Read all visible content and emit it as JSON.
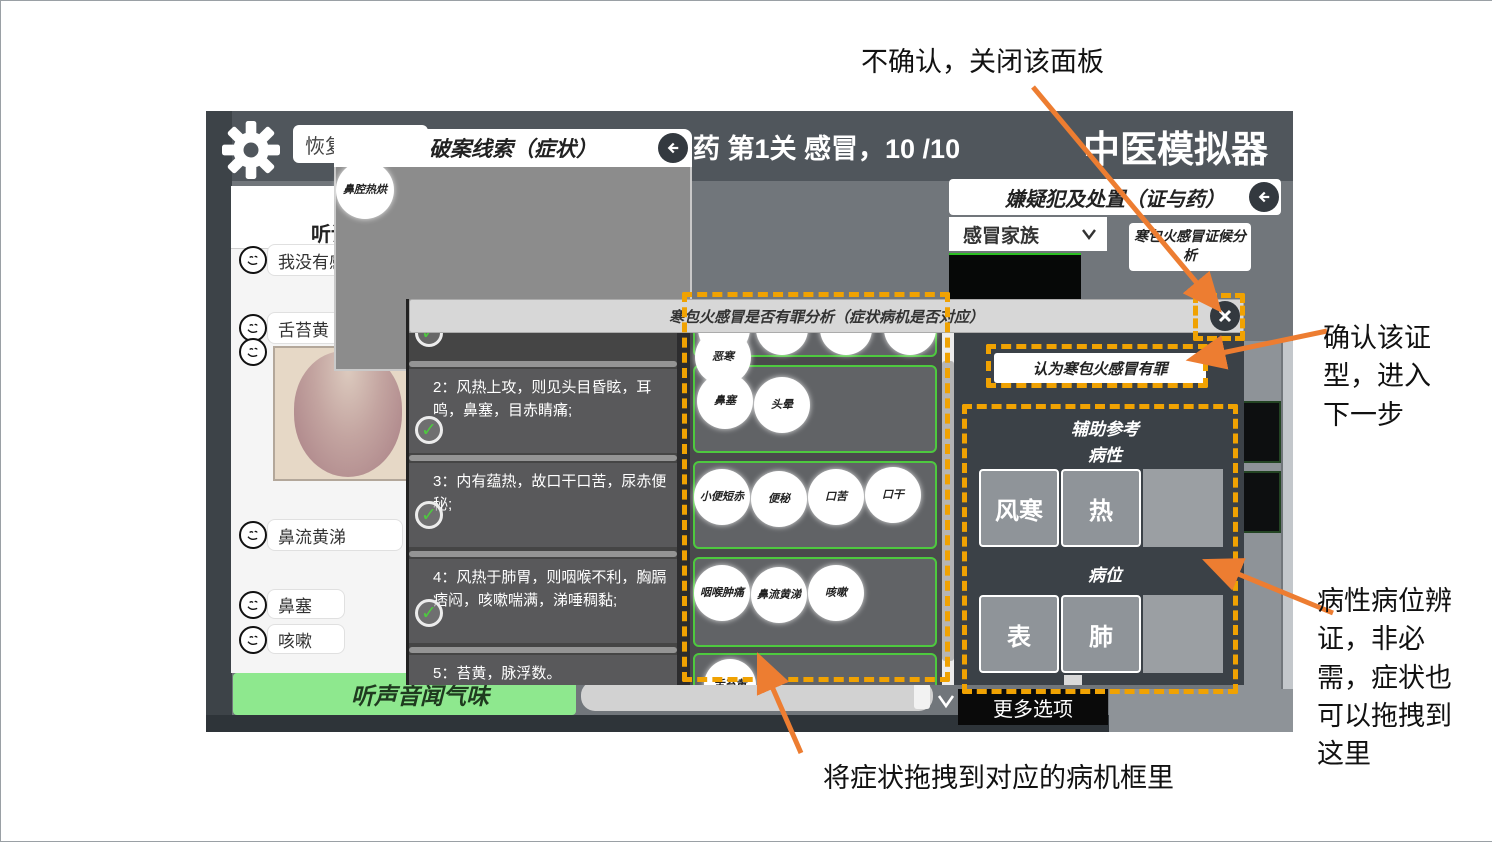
{
  "annotations": {
    "close_note": "不确认，关闭该面板",
    "confirm_note": "确认该证型，进入下一步",
    "aux_note": "病性病位辨证，非必需，症状也可以拖拽到这里",
    "drag_note": "将症状拖拽到对应的病机框里"
  },
  "header": {
    "restore": "恢复",
    "level": "药 第1关 感冒，10 /10",
    "app_title": "中医模拟器"
  },
  "clue_panel": {
    "title": "破案线索（症状）",
    "clue": "鼻腔热烘"
  },
  "chat": {
    "tab": "听诊",
    "messages": [
      "我没有感",
      "舌苔黄",
      "鼻流黄涕",
      "鼻塞",
      "咳嗽"
    ],
    "listen_button": "听声音闻气味"
  },
  "suspects": {
    "title": "嫌疑犯及处置（证与药）",
    "family": "感冒家族",
    "current": "风寒感冒",
    "analysis": "寒包火感冒证候分析",
    "more": "更多选项"
  },
  "dialog": {
    "title": "寒包火感冒是否有罪分析（症状病机是否对应）",
    "items": [
      "2：风热上攻，则见头目昏眩，耳鸣，鼻塞，目赤睛痛;",
      "3：内有蕴热，故口干口苦，尿赤便秘;",
      "4：风热于肺胃，则咽喉不利，胸膈痞闷，咳嗽喘满，涕唾稠黏;",
      "5：苔黄，脉浮数。"
    ],
    "symptoms": {
      "dragging": "恶寒",
      "zone2": [
        "鼻塞",
        "头晕"
      ],
      "zone3": [
        "小便短赤",
        "便秘",
        "口苦",
        "口干"
      ],
      "zone4": [
        "咽喉肿痛",
        "鼻流黄涕",
        "咳嗽"
      ],
      "zone5": [
        "舌苔黄"
      ]
    },
    "verdict_button": "认为寒包火感冒有罪",
    "aux": {
      "title": "辅助参考",
      "nature_label": "病性",
      "nature": [
        "风寒",
        "热"
      ],
      "location_label": "病位",
      "location": [
        "表",
        "肺"
      ]
    }
  },
  "icons": {
    "gear": "⚙",
    "back": "⬅",
    "close": "✕",
    "chevron_down": "∨",
    "check": "✓"
  },
  "colors": {
    "highlight": "#F0A202",
    "arrow": "#ED7D31",
    "suspect_green": "#35E52A",
    "zone_border": "#4EC93F",
    "listen_green": "#8EE88E"
  }
}
